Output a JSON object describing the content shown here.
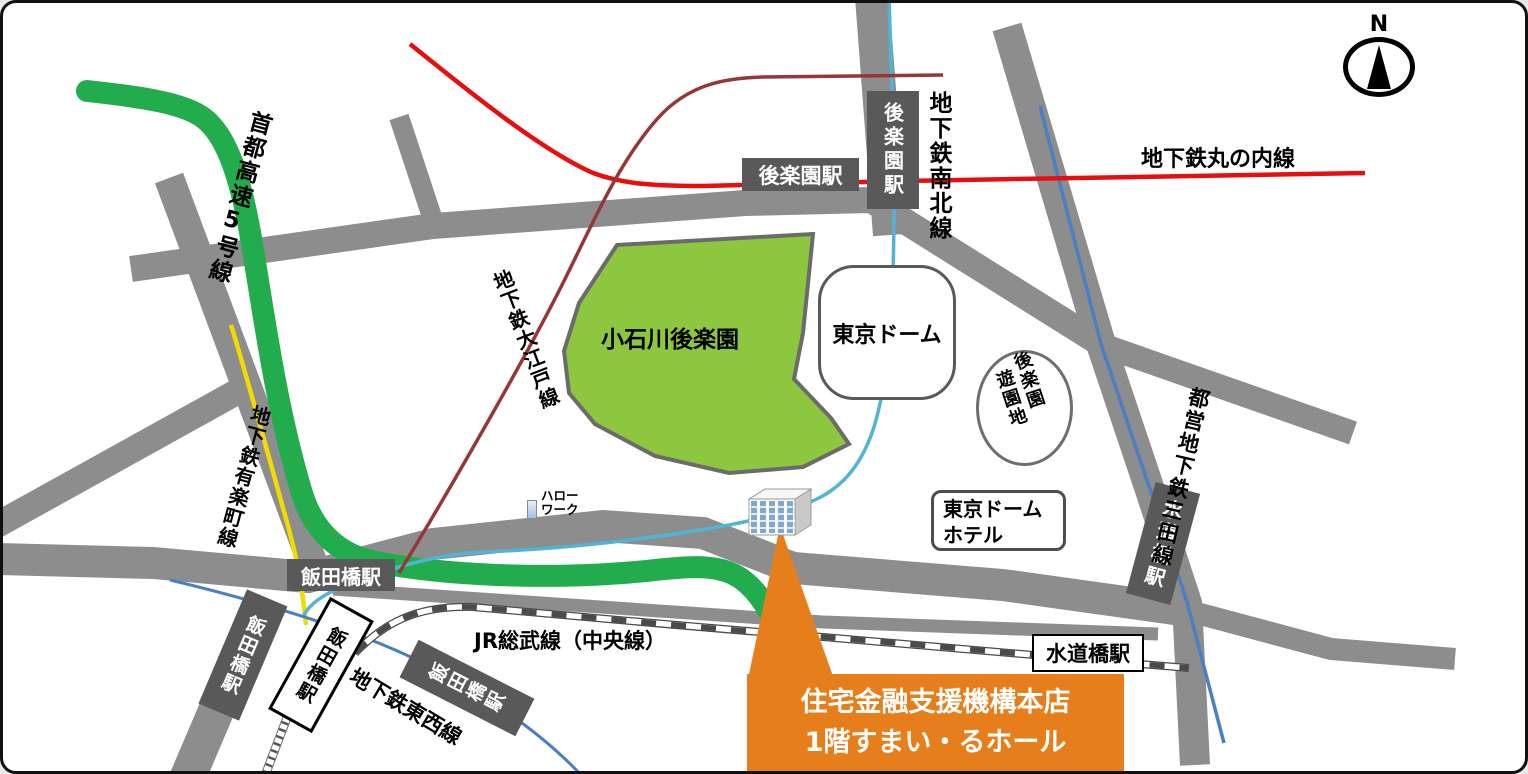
{
  "map": {
    "compass_label": "N",
    "lines": {
      "shuto_expressway": "首都高速5号線",
      "yurakucho": "地下鉄有楽町線",
      "oedo": "地下鉄大江戸線",
      "marunouchi": "地下鉄丸の内線",
      "namboku": "地下鉄南北線",
      "mita": "都営地下鉄三田線",
      "tozai": "地下鉄東西線",
      "jr_sobu": "JR総武線（中央線）"
    },
    "stations": {
      "korakuen_h": "後楽園駅",
      "korakuen_v": "後楽園駅",
      "iidabashi_main": "飯田橋駅",
      "iidabashi_rot1": "飯田橋駅",
      "iidabashi_rot2": "飯田橋駅",
      "iidabashi_tozai": "飯田橋駅",
      "suidobashi_jr": "水道橋駅",
      "suidobashi_mita": "水道橋駅"
    },
    "places": {
      "koishikawa_park": "小石川後楽園",
      "tokyo_dome": "東京ドーム",
      "amusement_col_right": "後楽園",
      "amusement_col_left": "遊園地",
      "hotel_line1": "東京ドーム",
      "hotel_line2": "ホテル",
      "hellowork_line1": "ハロー",
      "hellowork_line2": "ワーク"
    },
    "destination": {
      "line1": "住宅金融支援機構本店",
      "line2": "1階すまい・るホール"
    },
    "colors": {
      "road_gray": "#8D8D8D",
      "station_box_gray": "#595959",
      "expressway_green": "#23AC4E",
      "park_green": "#8DC63F",
      "marunouchi_red": "#E80E0E",
      "oedo_dark_red": "#953735",
      "namboku_teal": "#52B4D4",
      "mita_blue": "#4A7FC1",
      "tozai_blue": "#4A7FC1",
      "yurakucho_yellow": "#F2DB00",
      "highlight_orange": "#E67E1B"
    }
  }
}
